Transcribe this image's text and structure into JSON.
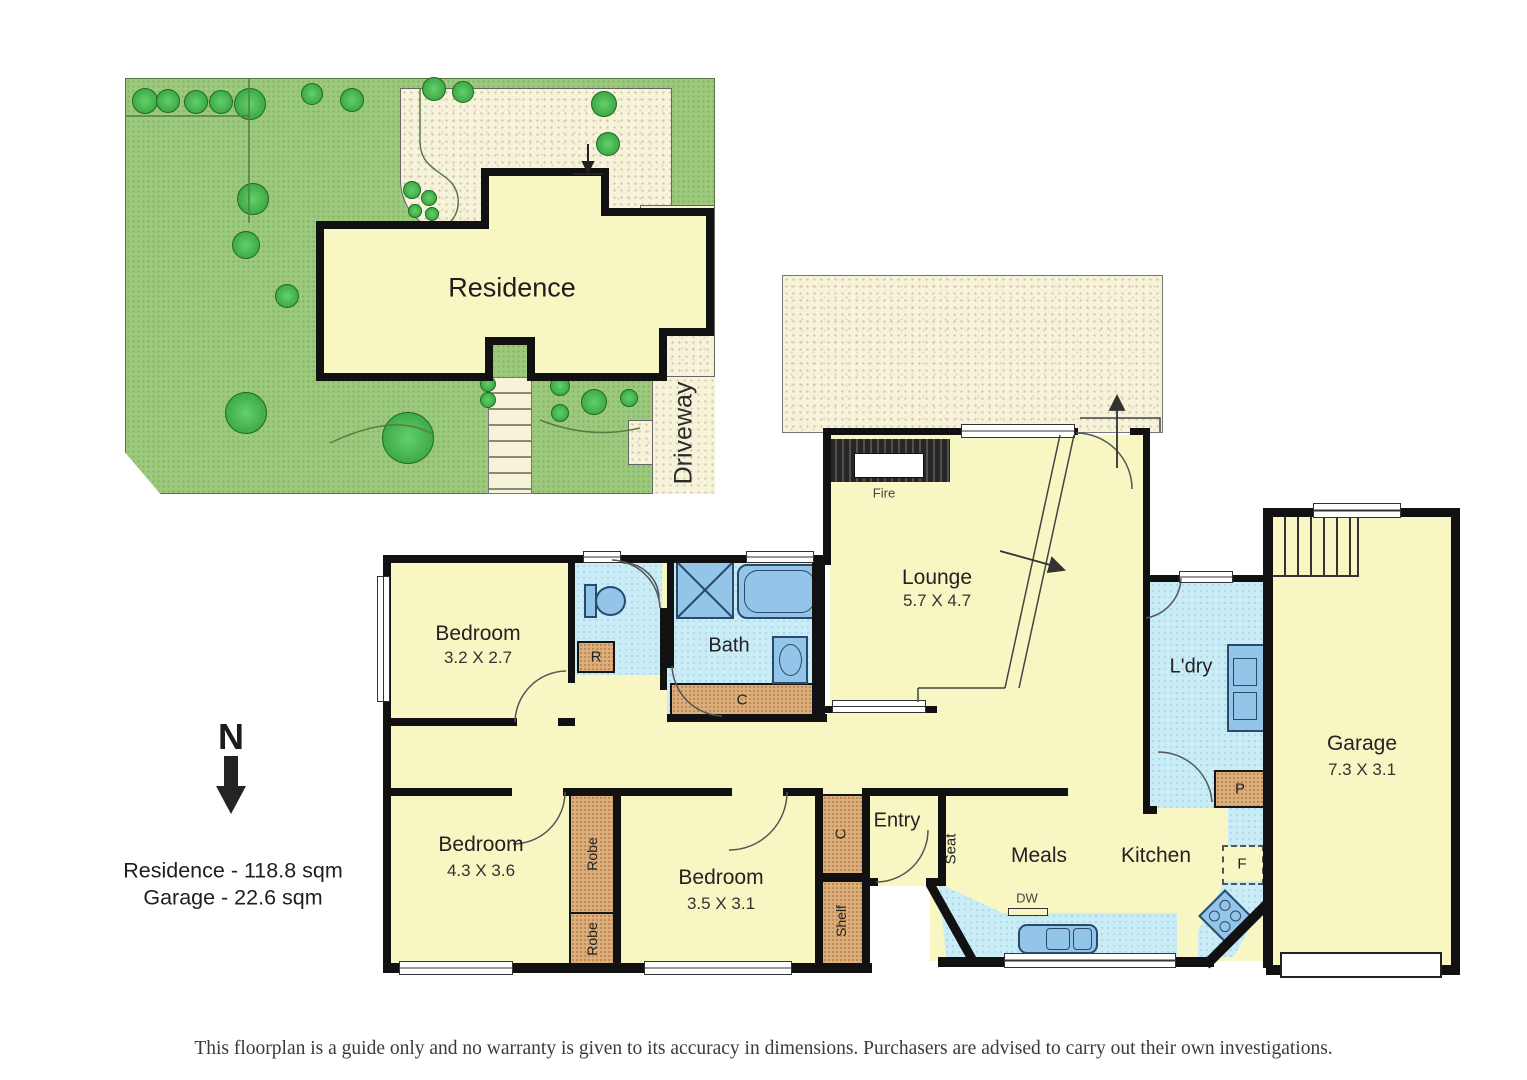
{
  "site_plan": {
    "residence": "Residence",
    "driveway": "Driveway"
  },
  "north": {
    "label": "N"
  },
  "summary": {
    "residence_area": "Residence - 118.8 sqm",
    "garage_area": "Garage - 22.6 sqm"
  },
  "rooms": {
    "bedroom1": {
      "name": "Bedroom",
      "dims": "3.2 X 2.7"
    },
    "bedroom2": {
      "name": "Bedroom",
      "dims": "4.3 X 3.6"
    },
    "bedroom3": {
      "name": "Bedroom",
      "dims": "3.5 X 3.1"
    },
    "lounge": {
      "name": "Lounge",
      "dims": "5.7 X 4.7"
    },
    "garage": {
      "name": "Garage",
      "dims": "7.3 X 3.1"
    },
    "bath": {
      "name": "Bath"
    },
    "laundry": {
      "name": "L'dry"
    },
    "entry": {
      "name": "Entry"
    },
    "meals": {
      "name": "Meals"
    },
    "kitchen": {
      "name": "Kitchen"
    }
  },
  "fixtures": {
    "fireplace": "Fire",
    "robe_single": "R",
    "bath_cupboard": "C",
    "entry_cupboard": "C",
    "robe_1": "Robe",
    "robe_2": "Robe",
    "shelf": "Shelf",
    "seat": "Seat",
    "pantry": "P",
    "fridge": "F",
    "dishwasher": "DW"
  },
  "colors": {
    "floor": "#f8f6c3",
    "wet_area": "#c9ecf6",
    "fixture_blue": "#92c5e8",
    "joinery_tan": "#dcae7c",
    "lawn_green": "#9cca7d",
    "paving": "#f6f3da",
    "wall": "#111111"
  },
  "disclaimer": "This floorplan is a guide only and no warranty is given to its accuracy in dimensions. Purchasers are advised to carry out their own investigations."
}
